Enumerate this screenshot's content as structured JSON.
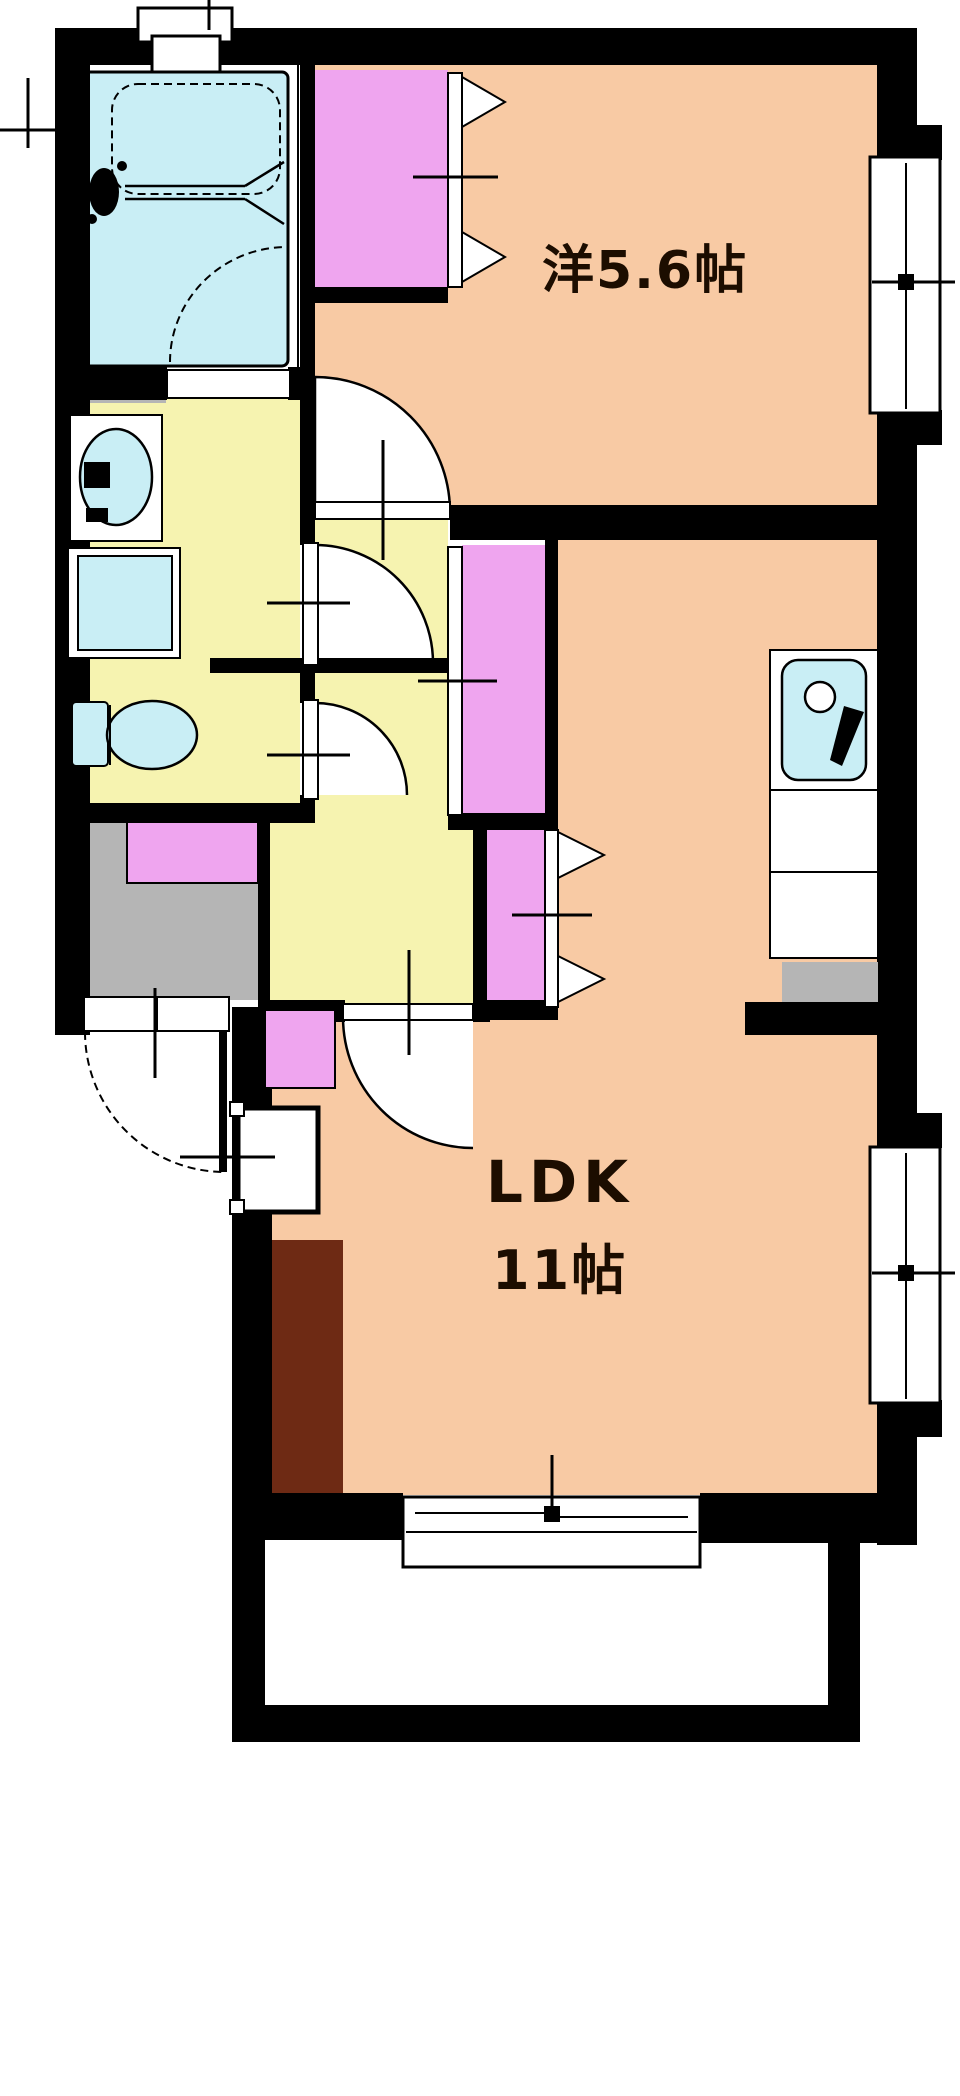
{
  "page": {
    "background": "#ffffff",
    "kind": "real-estate floor plan (madori-zu)"
  },
  "floor_plan": {
    "layout_type": "1LDK apartment",
    "rooms": [
      {
        "id": "western_room",
        "label": "洋5.6帖"
      },
      {
        "id": "ldk",
        "label": "LDK",
        "size_label": "11帖"
      }
    ],
    "colors": {
      "wall": "#000000",
      "room_peach": "#f8caa4",
      "hall_yellow": "#f6f3b0",
      "water_cyan": "#c9eef5",
      "closet_pink": "#efa5ef",
      "entrance_gray": "#b5b5b5",
      "counter_brown": "#6e2a14",
      "fixture_white": "#ffffff",
      "text": "#1c0d00"
    },
    "features": [
      "unit-bath",
      "bathtub",
      "bathroom-window",
      "washbasin",
      "washing-machine-pan",
      "toilet",
      "hallway",
      "entrance-genkan",
      "shoe-cabinet",
      "entrance-door",
      "meter-box",
      "closet-folding-doors",
      "kitchen-sink",
      "kitchen-counter",
      "refrigerator-space",
      "sliding-windows",
      "balcony-sliding-door",
      "balcony",
      "door-swing-arcs"
    ]
  }
}
